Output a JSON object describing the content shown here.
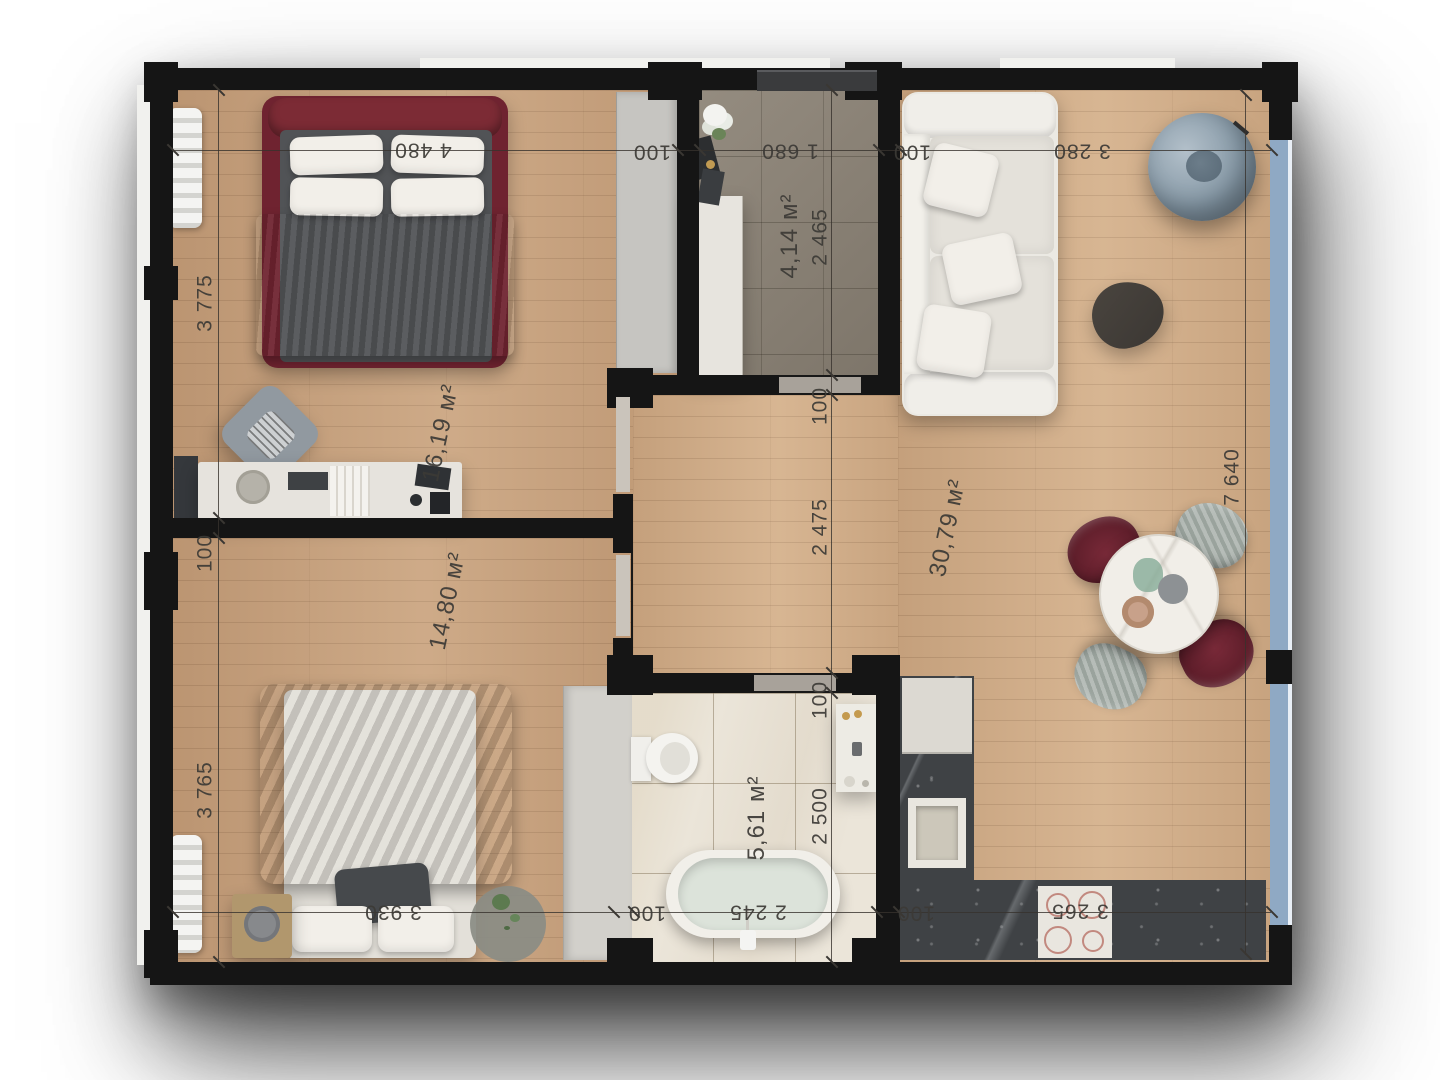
{
  "title": "apartment-floor-plan",
  "dims": {
    "top": [
      "4 480",
      "100",
      "1 680",
      "100",
      "3 280"
    ],
    "left": [
      "3 775",
      "100",
      "3 765"
    ],
    "mid": [
      "2 465",
      "100",
      "2 475",
      "100",
      "2 500"
    ],
    "right": [
      "7 640"
    ],
    "bottom": [
      "3 930",
      "100",
      "2 245",
      "100",
      "3 265"
    ]
  },
  "areas": {
    "bedroom1": "16,19 м²",
    "bedroom2": "14,80 м²",
    "entry": "4,14 м²",
    "living": "30,79 м²",
    "bathroom": "5,61 м²"
  },
  "colors": {
    "wall": "#151515",
    "wood_floor": "#c6a07c",
    "living_floor": "#d1ad88",
    "entry_tile": "#8c8376",
    "bath_tile": "#ebe5d9",
    "window_glass": "#8fa9c4",
    "bed_accent": "#6f2330",
    "chair_maroon": "#6e2433",
    "counter_marble": "#3f4245",
    "dim_text": "#3c3a36"
  }
}
